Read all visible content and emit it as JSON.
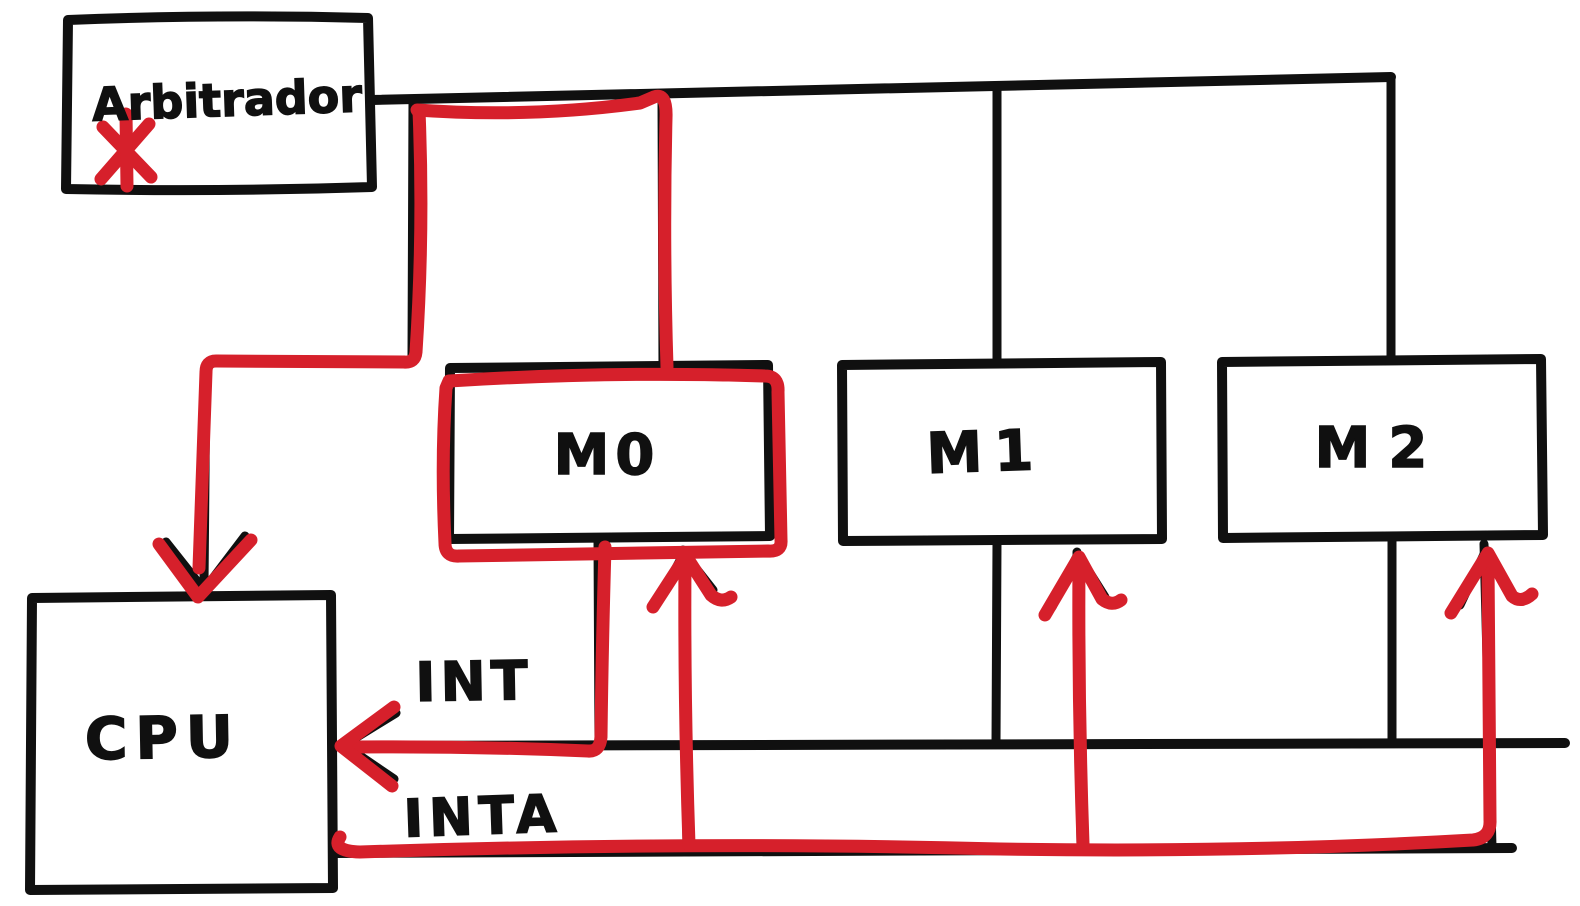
{
  "colors": {
    "ink": "#101010",
    "marker_red": "#d6202b",
    "background": "#ffffff"
  },
  "nodes": {
    "arbitrador": {
      "label": "Arbitrador"
    },
    "m0": {
      "label": "M0"
    },
    "m1": {
      "label": "M1"
    },
    "m2": {
      "label": "M2"
    },
    "cpu": {
      "label": "CPU"
    }
  },
  "signals": {
    "int": {
      "label": "INT"
    },
    "inta": {
      "label": "INTA"
    }
  },
  "annotations": {
    "asterisk_marker": "*"
  }
}
